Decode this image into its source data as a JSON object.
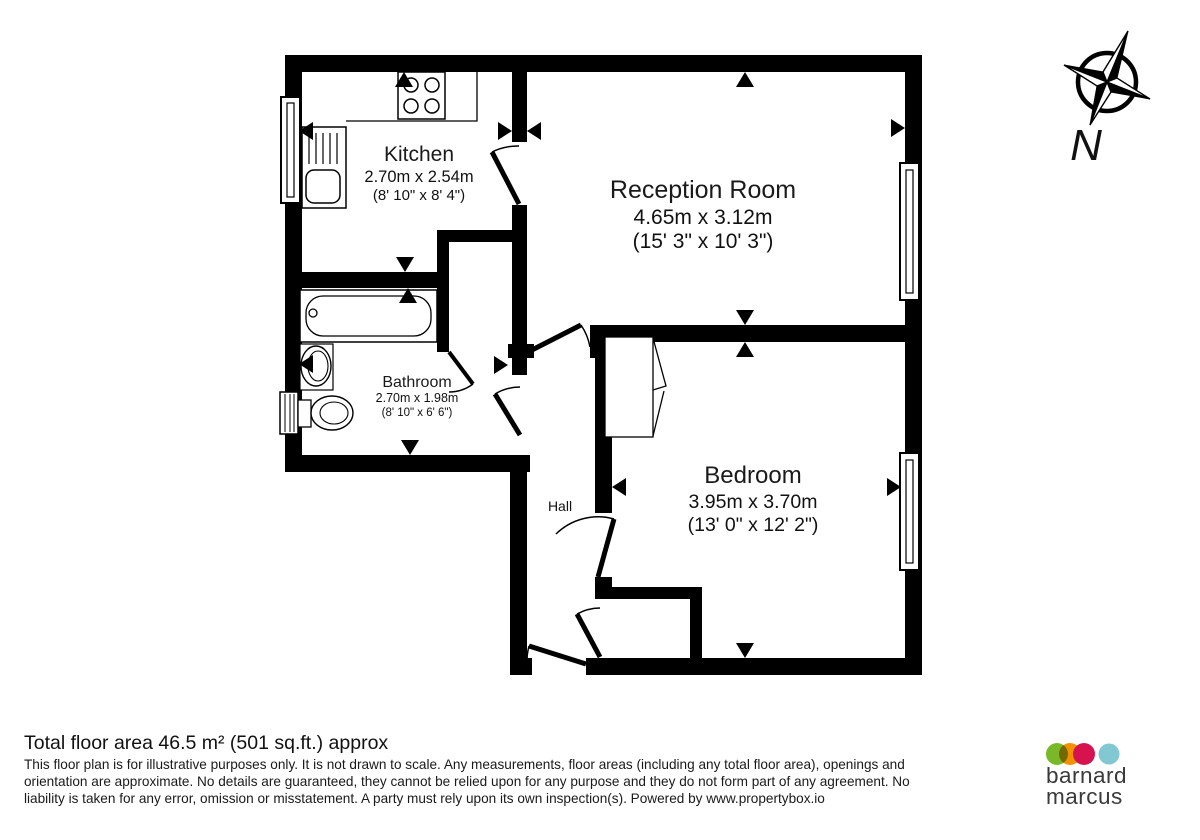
{
  "plan": {
    "rooms": {
      "kitchen": {
        "name": "Kitchen",
        "metric": "2.70m x 2.54m",
        "imperial": "(8' 10\" x 8' 4\")"
      },
      "reception": {
        "name": "Reception Room",
        "metric": "4.65m x 3.12m",
        "imperial": "(15' 3\" x 10' 3\")"
      },
      "bathroom": {
        "name": "Bathroom",
        "metric": "2.70m x 1.98m",
        "imperial": "(8' 10\" x 6' 6\")"
      },
      "bedroom": {
        "name": "Bedroom",
        "metric": "3.95m x 3.70m",
        "imperial": "(13' 0\" x 12' 2\")"
      },
      "hall": {
        "name": "Hall"
      }
    },
    "compass": {
      "label": "N"
    }
  },
  "footer": {
    "title": "Total floor area 46.5 m² (501 sq.ft.) approx",
    "disclaimer_lines": [
      "This floor plan is for illustrative purposes only. It is not drawn to scale. Any measurements, floor areas (including any total floor area), openings and",
      "orientation are approximate. No details are guaranteed, they cannot be relied upon for any purpose and they do not form part of any agreement. No",
      "liability is taken for any error, omission or misstatement. A party must rely upon its own inspection(s). Powered by www.propertybox.io"
    ]
  },
  "branding": {
    "name_line1": "barnard",
    "name_line2": "marcus",
    "dot_colors": {
      "green": "#79b829",
      "orange": "#f39200",
      "crimson": "#d6134f",
      "blue": "#82c8d3"
    }
  }
}
